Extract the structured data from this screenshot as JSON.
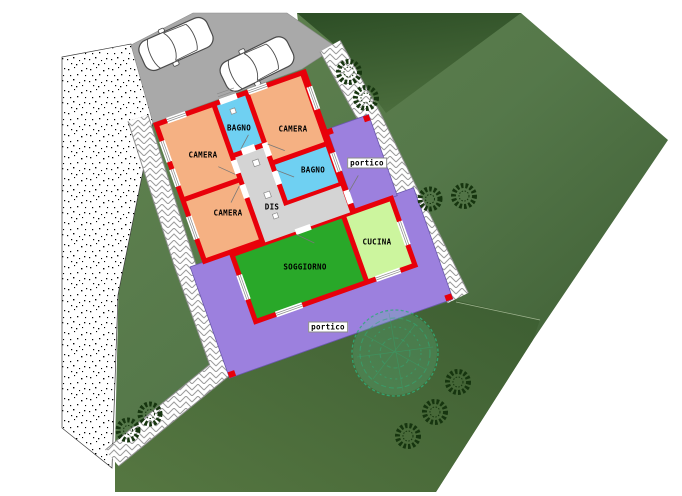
{
  "plan_labels": {
    "camera_top_left": "CAMERA",
    "bagno_top": "BAGNO",
    "camera_top_right": "CAMERA",
    "bagno_middle": "BAGNO",
    "disimpegno": "DIS",
    "camera_bottom": "CAMERA",
    "soggiorno": "SOGGIORNO",
    "cucina": "CUCINA",
    "portico_top_right": "portico",
    "portico_bottom": "portico"
  },
  "legend_colors": {
    "wall_red": "#e8000a",
    "camera_orange": "#f5b183",
    "bagno_blue": "#6fd0f2",
    "soggiorno_green": "#29a829",
    "cucina_lightgreen": "#ccf59e",
    "portico_purple": "#9c80de",
    "corridor_gray": "#d4d4d4",
    "driveway_gray": "#a9a9a9",
    "paving_white": "#ffffff",
    "lawn_green": "#4c6e3e"
  }
}
